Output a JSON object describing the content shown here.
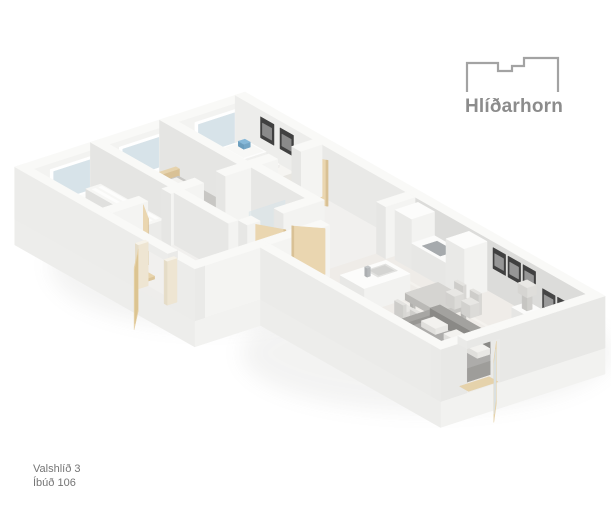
{
  "logo": {
    "name": "Hlíðarhorn",
    "icon": "building-outline-icon"
  },
  "caption": {
    "line1": "Valshlíð 3",
    "line2": "Íbúð 106"
  },
  "palette": {
    "background": "#ffffff",
    "logo_gray": "#8c8c8c",
    "caption_gray": "#757575",
    "wall_top": "#f9f9f7",
    "wall_light_face": "#f3f3f1",
    "wall_medium_face": "#e9e9e7",
    "wall_shaded_face": "#dcdcda",
    "wall_exterior": "#ebebe9",
    "slab_face": "#f2f2f0",
    "floor_light": "#f1f0ee",
    "floor_wood": "#efece8",
    "bathroom_floor": "#e8e8e7",
    "door_tan": "#ead6b0",
    "door_tan_shade": "#d9c195",
    "glass_blue": "#d7e3e9",
    "shower_tile_dark": "#55595c",
    "furniture_gray": "#a6a5a2",
    "bed_gray": "#c6c5c2",
    "pillow_white": "#f3f2ef",
    "stool_dark": "#45484b",
    "art_frame_dark": "#404040",
    "cooktop_gray": "#a6aaad"
  }
}
